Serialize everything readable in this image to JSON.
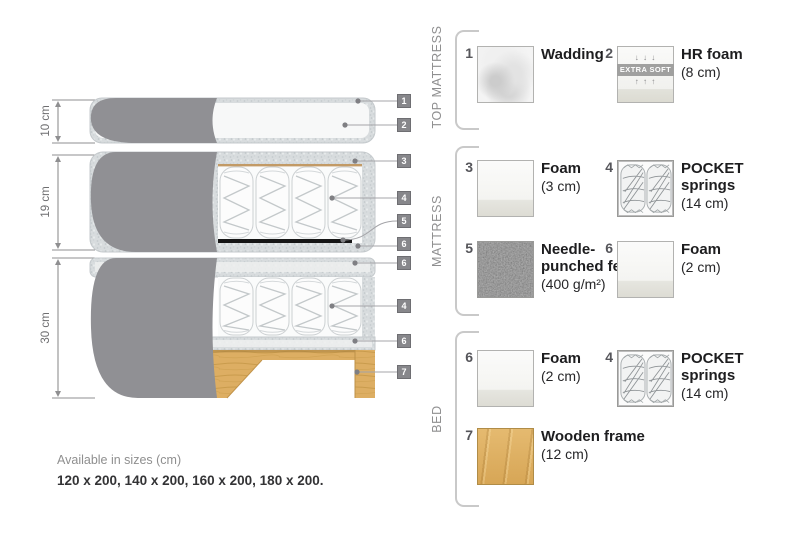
{
  "diagram": {
    "dimensions": [
      {
        "label": "10 cm"
      },
      {
        "label": "19 cm"
      },
      {
        "label": "30 cm"
      }
    ],
    "tags": [
      "1",
      "2",
      "3",
      "4",
      "5",
      "6",
      "6",
      "4",
      "6",
      "7"
    ]
  },
  "legend": {
    "sections": [
      {
        "label": "TOP MATTRESS",
        "items": [
          {
            "num": "1",
            "name": "Wadding",
            "size": ""
          },
          {
            "num": "2",
            "name": "HR foam",
            "size": "(8 cm)",
            "extra": "EXTRA SOFT",
            "arrows_down": "↓ ↓ ↓",
            "arrows_up": "↑ ↑ ↑"
          }
        ]
      },
      {
        "label": "MATTRESS",
        "items": [
          {
            "num": "3",
            "name": "Foam",
            "size": "(3 cm)"
          },
          {
            "num": "4",
            "name": "POCKET springs",
            "size": "(14 cm)"
          },
          {
            "num": "5",
            "name": "Needle-punched felt",
            "size": "(400 g/m²)"
          },
          {
            "num": "6",
            "name": "Foam",
            "size": "(2 cm)"
          }
        ]
      },
      {
        "label": "BED",
        "items": [
          {
            "num": "6",
            "name": "Foam",
            "size": "(2 cm)"
          },
          {
            "num": "4",
            "name": "POCKET springs",
            "size": "(14 cm)"
          },
          {
            "num": "7",
            "name": "Wooden frame",
            "size": "(12 cm)"
          }
        ]
      }
    ]
  },
  "footer": {
    "line1": "Available in sizes (cm)",
    "line2": "120 x 200, 140 x 200, 160 x 200, 180 x 200."
  },
  "colors": {
    "cover_gray": "#909094",
    "foam_speckle": "#d8dcde",
    "wood": "#ddae63",
    "felt": "#707070",
    "tag_bg": "#87878b"
  }
}
